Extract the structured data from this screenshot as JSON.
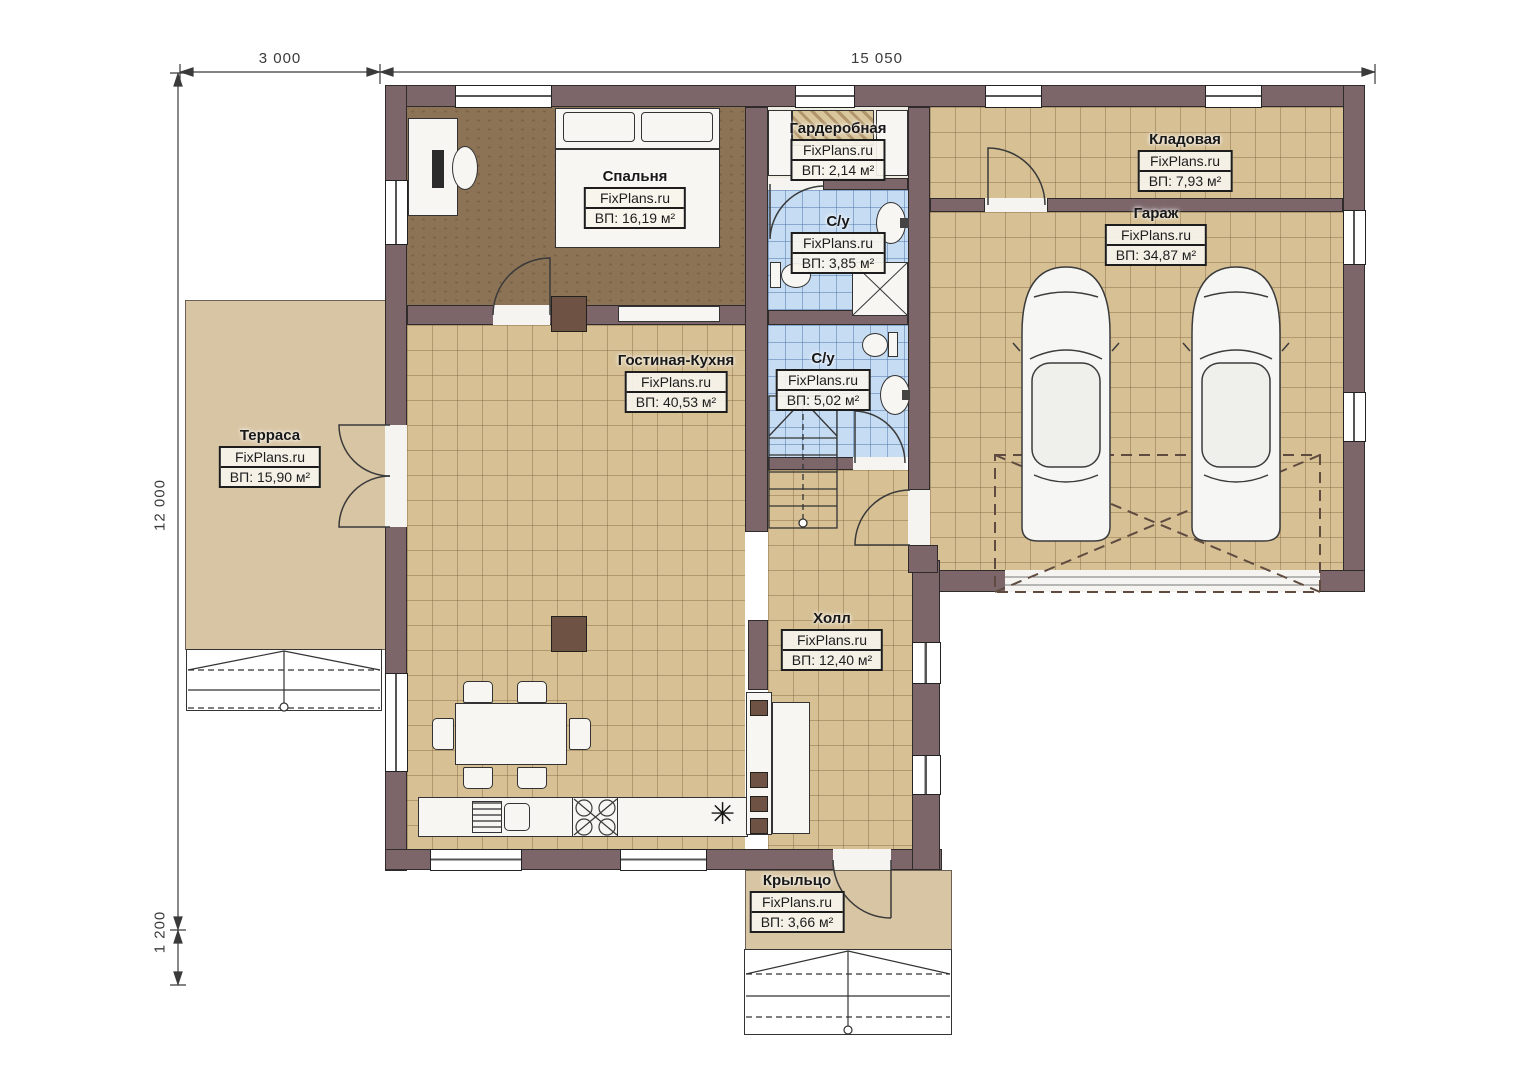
{
  "watermark": "FixPlans.ru",
  "dimensions": {
    "top_left": "3 000",
    "top_right": "15 050",
    "left_main": "12 000",
    "left_bottom": "1 200"
  },
  "rooms": [
    {
      "id": "bedroom",
      "name": "Спальня",
      "area": "ВП: 16,19 м²"
    },
    {
      "id": "wardrobe",
      "name": "Гардеробная",
      "area": "ВП: 2,14 м²"
    },
    {
      "id": "bath-top",
      "name": "С/у",
      "area": "ВП: 3,85 м²"
    },
    {
      "id": "storage",
      "name": "Кладовая",
      "area": "ВП: 7,93 м²"
    },
    {
      "id": "garage",
      "name": "Гараж",
      "area": "ВП: 34,87 м²"
    },
    {
      "id": "living-kitchen",
      "name": "Гостиная-Кухня",
      "area": "ВП: 40,53 м²"
    },
    {
      "id": "bath-bottom",
      "name": "С/у",
      "area": "ВП: 5,02 м²"
    },
    {
      "id": "terrace",
      "name": "Терраса",
      "area": "ВП: 15,90 м²"
    },
    {
      "id": "hall",
      "name": "Холл",
      "area": "ВП: 12,40 м²"
    },
    {
      "id": "porch",
      "name": "Крыльцо",
      "area": "ВП: 3,66 м²"
    }
  ],
  "symbols": {
    "kitchen_star": "✳"
  },
  "colors": {
    "wall": "#7c666a",
    "floor_tile": "#d6c094",
    "bath_tile": "#c6dcf3",
    "bedroom_floor": "#8d7355",
    "terrace": "#d8c5a3"
  }
}
